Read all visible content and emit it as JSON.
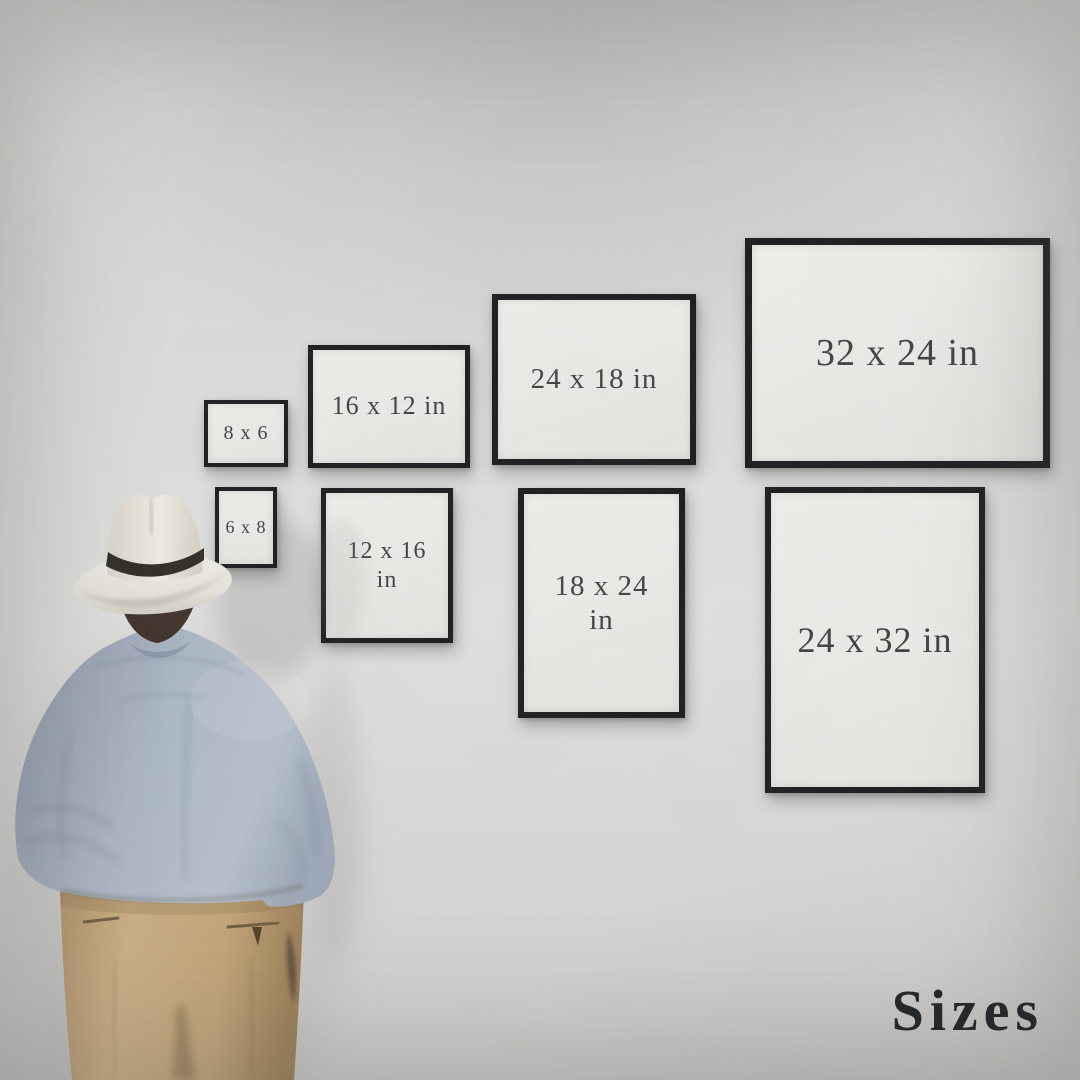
{
  "watermark": {
    "label": "Sizes"
  },
  "frames": [
    {
      "label": "8 x 6",
      "orientation": "landscape",
      "row": "top"
    },
    {
      "label": "16 x 12 in",
      "orientation": "landscape",
      "row": "top"
    },
    {
      "label": "24 x 18 in",
      "orientation": "landscape",
      "row": "top"
    },
    {
      "label": "32 x 24 in",
      "orientation": "landscape",
      "row": "top"
    },
    {
      "label": "6 x 8",
      "orientation": "portrait",
      "row": "bottom"
    },
    {
      "label": "12 x 16 in",
      "orientation": "portrait",
      "row": "bottom"
    },
    {
      "label": "18 x 24 in",
      "orientation": "portrait",
      "row": "bottom"
    },
    {
      "label": "24 x 32 in",
      "orientation": "portrait",
      "row": "bottom"
    }
  ],
  "colors": {
    "wall": "#d8d7d5",
    "frame-border": "#17171a",
    "frame-mat": "#ebebe8",
    "frame-text": "#3a3d40",
    "watermark-text": "#26292b",
    "hat": "#eae7e0",
    "hat-band": "#2c2620",
    "hair": "#3a2c24",
    "shirt": "#a5b0c0",
    "pants": "#c5a87d"
  }
}
